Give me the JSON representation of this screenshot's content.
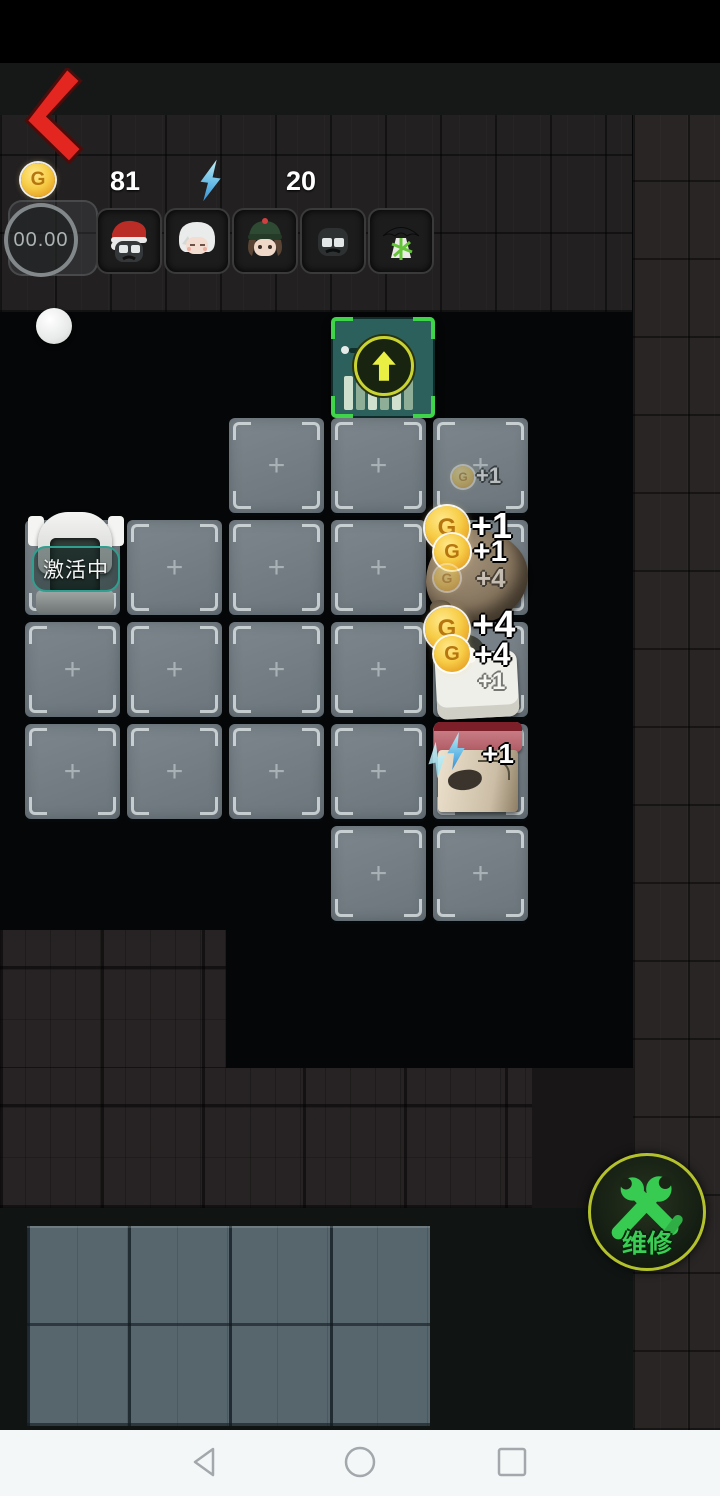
{
  "hud": {
    "coins": "81",
    "energy": "20",
    "timer": "00.00"
  },
  "coin_letter": "G",
  "activation": {
    "label": "激活中"
  },
  "repair": {
    "label": "维修"
  },
  "avatars": [
    {
      "id": "santa-goggles-avatar"
    },
    {
      "id": "white-hair-avatar"
    },
    {
      "id": "green-beanie-avatar"
    },
    {
      "id": "dark-goggles-avatar"
    },
    {
      "id": "umbrella-avatar"
    }
  ],
  "grid": {
    "origin_x": 25,
    "origin_y": 418,
    "cell": 95,
    "pitch_x": 102,
    "pitch_y": 102,
    "cells": [
      {
        "r": 0,
        "c": 2,
        "plus": true
      },
      {
        "r": 0,
        "c": 3,
        "plus": true
      },
      {
        "r": 0,
        "c": 4,
        "plus": true
      },
      {
        "r": 1,
        "c": 0,
        "plus": false
      },
      {
        "r": 1,
        "c": 1,
        "plus": true
      },
      {
        "r": 1,
        "c": 2,
        "plus": true
      },
      {
        "r": 1,
        "c": 3,
        "plus": true
      },
      {
        "r": 1,
        "c": 4,
        "plus": false
      },
      {
        "r": 2,
        "c": 0,
        "plus": true
      },
      {
        "r": 2,
        "c": 1,
        "plus": true
      },
      {
        "r": 2,
        "c": 2,
        "plus": true
      },
      {
        "r": 2,
        "c": 3,
        "plus": true
      },
      {
        "r": 2,
        "c": 4,
        "plus": false
      },
      {
        "r": 3,
        "c": 0,
        "plus": true
      },
      {
        "r": 3,
        "c": 1,
        "plus": true
      },
      {
        "r": 3,
        "c": 2,
        "plus": true
      },
      {
        "r": 3,
        "c": 3,
        "plus": true
      },
      {
        "r": 3,
        "c": 4,
        "plus": false
      },
      {
        "r": 4,
        "c": 3,
        "plus": true
      },
      {
        "r": 4,
        "c": 4,
        "plus": true
      }
    ],
    "plus_glyph": "+"
  },
  "rewards": [
    {
      "text": "+1",
      "tx": 476,
      "ty": 463,
      "font": 22,
      "faded": true,
      "coin": {
        "x": 452,
        "y": 466,
        "size": 22,
        "faded": true
      }
    },
    {
      "text": "+1",
      "tx": 471,
      "ty": 505,
      "font": 36,
      "faded": false,
      "coin": {
        "x": 425,
        "y": 506,
        "size": 44,
        "faded": false
      }
    },
    {
      "text": "+1",
      "tx": 473,
      "ty": 535,
      "font": 30,
      "faded": false,
      "coin": {
        "x": 434,
        "y": 534,
        "size": 36,
        "faded": false
      }
    },
    {
      "text": "+4",
      "tx": 476,
      "ty": 563,
      "font": 26,
      "faded": true,
      "coin": {
        "x": 434,
        "y": 565,
        "size": 26,
        "faded": true
      }
    },
    {
      "text": "+4",
      "tx": 472,
      "ty": 604,
      "font": 38,
      "faded": false,
      "coin": {
        "x": 425,
        "y": 607,
        "size": 44,
        "faded": false
      }
    },
    {
      "text": "+4",
      "tx": 474,
      "ty": 636,
      "font": 32,
      "faded": false,
      "coin": {
        "x": 434,
        "y": 636,
        "size": 36,
        "faded": false
      }
    },
    {
      "text": "+1",
      "tx": 478,
      "ty": 668,
      "font": 24,
      "faded": true,
      "coin": null
    },
    {
      "text": "+1",
      "tx": 482,
      "ty": 738,
      "font": 28,
      "faded": false,
      "coin": null,
      "bolt": {
        "x": 444,
        "y": 732,
        "w": 24,
        "h": 38
      }
    }
  ],
  "nav": {
    "back": "back",
    "home": "home",
    "recents": "recents"
  }
}
